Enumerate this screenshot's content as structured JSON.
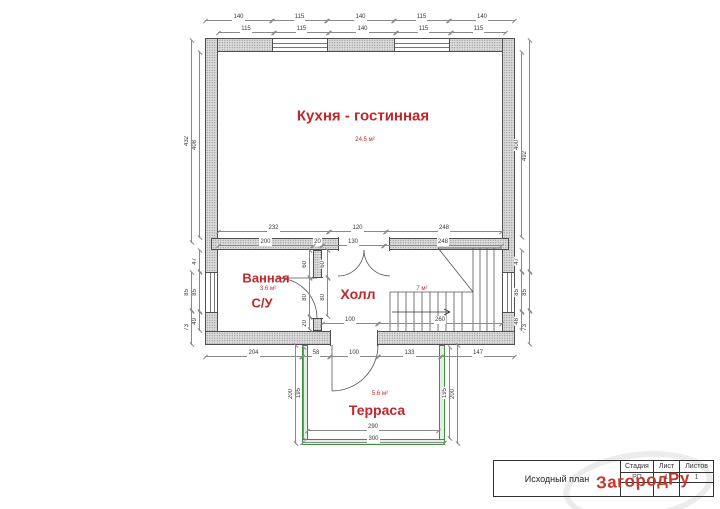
{
  "rooms": {
    "kitchen": {
      "name": "Кухня - гостинная",
      "area": "24.5 м²"
    },
    "bathroom": {
      "name": "Ванная",
      "area": "3.6 м²",
      "su": "С/У"
    },
    "hall": {
      "name": "Холл",
      "area": "7 м²"
    },
    "terrace": {
      "name": "Терраса",
      "area": "5.6 м²"
    }
  },
  "title_block": {
    "plan_name": "Исходный план",
    "stage_label": "Стадия",
    "sheet_label": "Лист",
    "sheets_label": "Листов",
    "stage_value": "РП",
    "sheet_value": "1",
    "sheets_value": "1"
  },
  "watermark": {
    "text": "ЗагородРу",
    "color": "#c4372a"
  },
  "plan": {
    "colors": {
      "wall_gray": "#dadada",
      "terrace_green": "#3f8f3f",
      "label_red": "#c2262b"
    },
    "dimensions": [
      {
        "t": "140",
        "x": 205,
        "y": 20,
        "l": 67,
        "o": "h"
      },
      {
        "t": "115",
        "x": 272,
        "y": 20,
        "l": 55,
        "o": "h"
      },
      {
        "t": "140",
        "x": 327,
        "y": 20,
        "l": 67,
        "o": "h"
      },
      {
        "t": "115",
        "x": 394,
        "y": 20,
        "l": 55,
        "o": "h"
      },
      {
        "t": "140",
        "x": 449,
        "y": 20,
        "l": 66,
        "o": "h"
      },
      {
        "t": "115",
        "x": 218,
        "y": 32,
        "l": 56,
        "o": "h"
      },
      {
        "t": "115",
        "x": 274,
        "y": 32,
        "l": 55,
        "o": "h"
      },
      {
        "t": "140",
        "x": 329,
        "y": 32,
        "l": 67,
        "o": "h"
      },
      {
        "t": "115",
        "x": 396,
        "y": 32,
        "l": 55,
        "o": "h"
      },
      {
        "t": "115",
        "x": 451,
        "y": 32,
        "l": 55,
        "o": "h"
      },
      {
        "t": "232",
        "x": 218,
        "y": 231,
        "l": 111,
        "o": "h"
      },
      {
        "t": "120",
        "x": 329,
        "y": 231,
        "l": 57,
        "o": "h"
      },
      {
        "t": "248",
        "x": 386,
        "y": 231,
        "l": 116,
        "o": "h"
      },
      {
        "t": "200",
        "x": 218,
        "y": 245,
        "l": 95,
        "o": "h"
      },
      {
        "t": "20",
        "x": 313,
        "y": 245,
        "l": 9,
        "o": "h"
      },
      {
        "t": "130",
        "x": 322,
        "y": 245,
        "l": 62,
        "o": "h"
      },
      {
        "t": "248",
        "x": 384,
        "y": 245,
        "l": 118,
        "o": "h"
      },
      {
        "t": "100",
        "x": 322,
        "y": 323,
        "l": 56,
        "o": "h"
      },
      {
        "t": "260",
        "x": 378,
        "y": 323,
        "l": 124,
        "o": "h"
      },
      {
        "t": "204",
        "x": 205,
        "y": 356,
        "l": 97,
        "o": "h"
      },
      {
        "t": "58",
        "x": 302,
        "y": 356,
        "l": 28,
        "o": "h"
      },
      {
        "t": "100",
        "x": 330,
        "y": 356,
        "l": 48,
        "o": "h"
      },
      {
        "t": "133",
        "x": 378,
        "y": 356,
        "l": 63,
        "o": "h"
      },
      {
        "t": "147",
        "x": 441,
        "y": 356,
        "l": 74,
        "o": "h"
      },
      {
        "t": "290",
        "x": 307,
        "y": 430,
        "l": 132,
        "o": "h"
      },
      {
        "t": "300",
        "x": 302,
        "y": 442,
        "l": 143,
        "o": "h"
      },
      {
        "t": "432",
        "x": 191,
        "y": 40,
        "l": 203,
        "o": "v"
      },
      {
        "t": "85",
        "x": 191,
        "y": 272,
        "l": 40,
        "o": "v"
      },
      {
        "t": "73",
        "x": 191,
        "y": 310,
        "l": 35,
        "o": "v"
      },
      {
        "t": "408",
        "x": 199,
        "y": 52,
        "l": 186,
        "o": "v"
      },
      {
        "t": "47",
        "x": 199,
        "y": 250,
        "l": 22,
        "o": "v"
      },
      {
        "t": "85",
        "x": 199,
        "y": 272,
        "l": 40,
        "o": "v"
      },
      {
        "t": "49",
        "x": 199,
        "y": 312,
        "l": 19,
        "o": "v"
      },
      {
        "t": "400",
        "x": 521,
        "y": 52,
        "l": 186,
        "o": "v"
      },
      {
        "t": "47",
        "x": 521,
        "y": 250,
        "l": 22,
        "o": "v"
      },
      {
        "t": "85",
        "x": 521,
        "y": 272,
        "l": 40,
        "o": "v"
      },
      {
        "t": "48",
        "x": 521,
        "y": 312,
        "l": 19,
        "o": "v"
      },
      {
        "t": "492",
        "x": 529,
        "y": 40,
        "l": 232,
        "o": "v"
      },
      {
        "t": "85",
        "x": 529,
        "y": 272,
        "l": 40,
        "o": "v"
      },
      {
        "t": "73",
        "x": 529,
        "y": 310,
        "l": 35,
        "o": "v"
      },
      {
        "t": "60",
        "x": 309,
        "y": 250,
        "l": 28,
        "o": "v"
      },
      {
        "t": "80",
        "x": 309,
        "y": 278,
        "l": 39,
        "o": "v"
      },
      {
        "t": "20",
        "x": 309,
        "y": 317,
        "l": 13,
        "o": "v"
      },
      {
        "t": "60",
        "x": 327,
        "y": 250,
        "l": 28,
        "o": "v"
      },
      {
        "t": "80",
        "x": 327,
        "y": 278,
        "l": 39,
        "o": "v"
      },
      {
        "t": "200",
        "x": 295,
        "y": 345,
        "l": 99,
        "o": "v"
      },
      {
        "t": "195",
        "x": 303,
        "y": 347,
        "l": 92,
        "o": "v"
      },
      {
        "t": "195",
        "x": 449,
        "y": 347,
        "l": 92,
        "o": "v"
      },
      {
        "t": "200",
        "x": 457,
        "y": 345,
        "l": 99,
        "o": "v"
      }
    ]
  }
}
